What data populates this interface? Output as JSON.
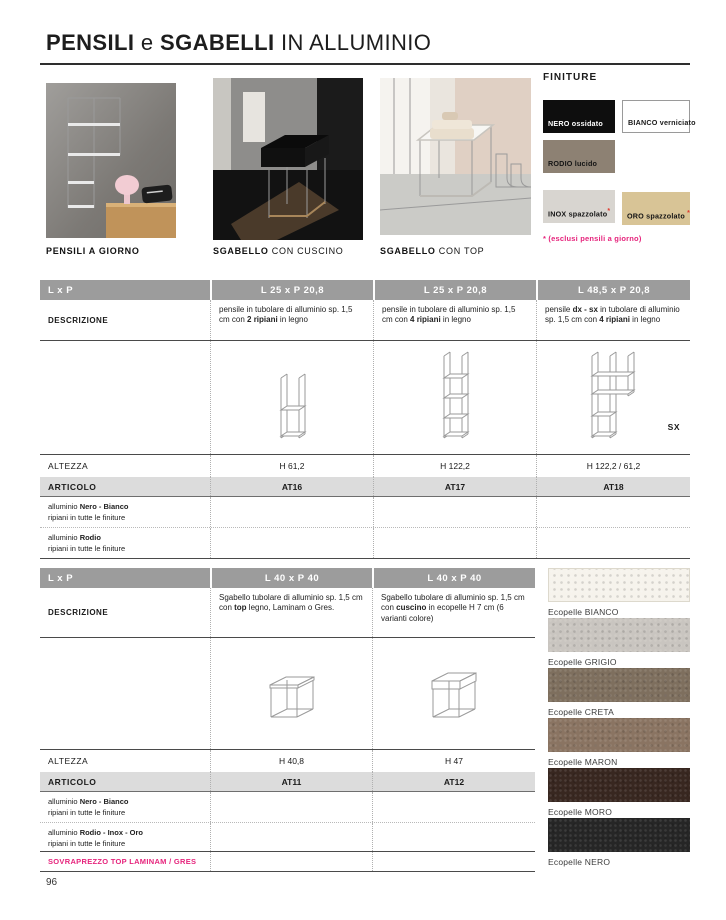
{
  "page": {
    "title": {
      "b1": "PENSILI",
      "r1": " e ",
      "b2": "SGABELLI",
      "r2": " IN ALLUMINIO"
    },
    "page_number": "96"
  },
  "photos": [
    {
      "caption_b": "PENSILI A GIORNO",
      "caption_r": ""
    },
    {
      "caption_b": "SGABELLO",
      "caption_r": " CON CUSCINO"
    },
    {
      "caption_b": "SGABELLO",
      "caption_r": " CON TOP"
    }
  ],
  "finiture": {
    "heading": "FINITURE",
    "swatches": [
      {
        "b": "NERO",
        "r": " ossidato",
        "star": "",
        "color": "#0e0e0e",
        "text": "#ffffff"
      },
      {
        "b": "BIANCO",
        "r": " verniciato",
        "star": "",
        "color": "#ffffff",
        "text": "#1a1a1a"
      },
      {
        "b": "RODIO",
        "r": " lucido",
        "star": "",
        "color": "#8d8173",
        "text": "#141414"
      },
      {
        "b": "INOX",
        "r": " spazzolato",
        "star": "*",
        "color": "#d8d5d0",
        "text": "#141414"
      },
      {
        "b": "ORO",
        "r": " spazzolato",
        "star": " *",
        "color": "#d8c496",
        "text": "#141414"
      }
    ],
    "note": "* (esclusi pensili a giorno)"
  },
  "table1": {
    "lxp": "L x P",
    "cols": [
      "L 25 x P 20,8",
      "L 25 x P 20,8",
      "L 48,5 x P 20,8"
    ],
    "descrizione": "DESCRIZIONE",
    "desc": [
      {
        "p1": "pensile in tubolare di alluminio sp. 1,5 cm con ",
        "b1": "2 ripiani",
        "p2": " in legno"
      },
      {
        "p1": "pensile in tubolare di alluminio sp. 1,5 cm con ",
        "b1": "4 ripiani",
        "p2": " in legno"
      },
      {
        "p1": "pensile ",
        "b1": "dx - sx",
        "p2": " in tubolare di alluminio sp. 1,5 cm con ",
        "b2": "4 ripiani",
        "p3": " in legno"
      }
    ],
    "sx": "SX",
    "altezza": "ALTEZZA",
    "heights": [
      "H 61,2",
      "H 122,2",
      "H 122,2 / 61,2"
    ],
    "articolo": "ARTICOLO",
    "articles": [
      "AT16",
      "AT17",
      "AT18"
    ],
    "finishes": [
      {
        "p1": "alluminio ",
        "b1": "Nero - Bianco",
        "l2": "ripiani in tutte le finiture"
      },
      {
        "p1": "alluminio ",
        "b1": "Rodio",
        "l2": "ripiani in tutte le finiture"
      }
    ]
  },
  "table2": {
    "lxp": "L x P",
    "cols": [
      "L 40 x P 40",
      "L 40 x P 40"
    ],
    "descrizione": "DESCRIZIONE",
    "desc": [
      {
        "p1": "Sgabello tubolare di alluminio sp. 1,5 cm con ",
        "b1": "top",
        "p2": " legno, Laminam o Gres."
      },
      {
        "p1": "Sgabello tubolare di alluminio sp. 1,5 cm con ",
        "b1": "cuscino",
        "p2": " in ecopelle H 7 cm (6 varianti colore)"
      }
    ],
    "altezza": "ALTEZZA",
    "heights": [
      "H 40,8",
      "H 47"
    ],
    "articolo": "ARTICOLO",
    "articles": [
      "AT11",
      "AT12"
    ],
    "finishes": [
      {
        "p1": "alluminio ",
        "b1": "Nero - Bianco",
        "l2": "ripiani in tutte le finiture"
      },
      {
        "p1": "alluminio ",
        "b1": "Rodio - Inox - Oro",
        "l2": "ripiani in tutte le finiture"
      }
    ],
    "sovrapprezzo": "SOVRAPREZZO TOP LAMINAM / GRES"
  },
  "ecopelle": [
    {
      "label": "Ecopelle BIANCO",
      "color": "#f6f3ec"
    },
    {
      "label": "Ecopelle GRIGIO",
      "color": "#c9c5c0"
    },
    {
      "label": "Ecopelle CRETA",
      "color": "#7e6f5e"
    },
    {
      "label": "Ecopelle MARON",
      "color": "#8a7462"
    },
    {
      "label": "Ecopelle MORO",
      "color": "#382720"
    },
    {
      "label": "Ecopelle NERO",
      "color": "#262626"
    }
  ],
  "colors": {
    "header_gray": "#9c9c9c",
    "articolo_gray": "#dcdcdc",
    "magenta": "#e6247c",
    "red_star": "#e03a2f"
  }
}
